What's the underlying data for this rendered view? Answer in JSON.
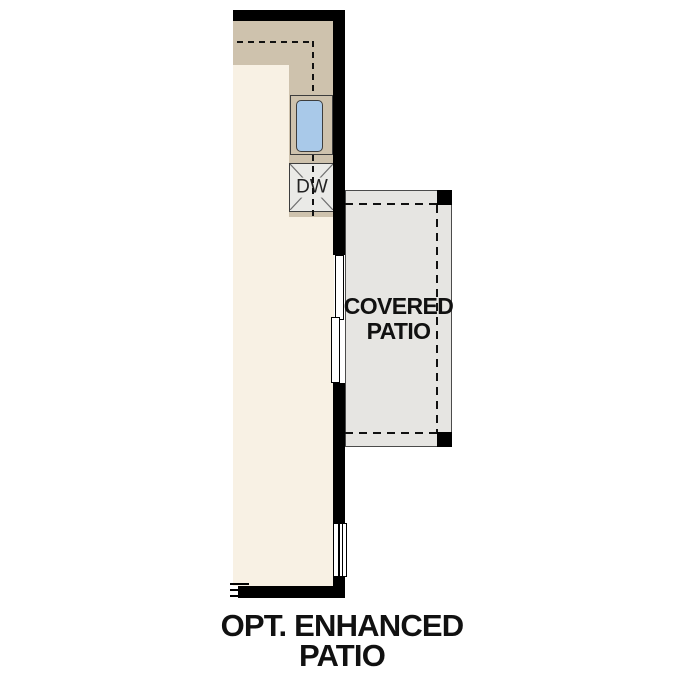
{
  "covered_patio": {
    "label_line1": "COVERED",
    "label_line2": "PATIO"
  },
  "caption": {
    "line1": "OPT. ENHANCED",
    "line2": "PATIO"
  },
  "kitchen": {
    "dishwasher_label": "DW"
  },
  "colors": {
    "wall": "#000000",
    "line": "#111111",
    "counter": "#cec2ad",
    "floor": "#f8f1e4",
    "patio": "#e6e5e2",
    "appliance": "#eaeae7",
    "sink_fill": "#a9c9e9",
    "outline": "#3d3d3d",
    "text": "#111111"
  }
}
